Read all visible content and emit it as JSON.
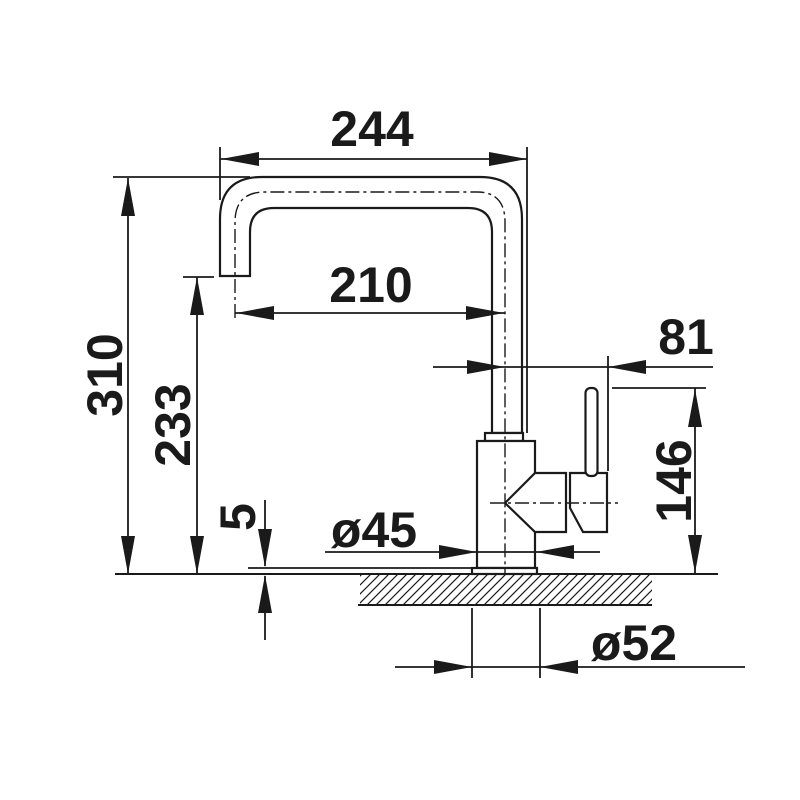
{
  "drawing": {
    "type": "faucet-dimension-diagram",
    "background": "#ffffff",
    "line_color": "#1a1a1a",
    "labels": {
      "spout_width_top": "244",
      "spout_reach": "210",
      "handle_offset": "81",
      "total_height": "310",
      "outlet_height": "233",
      "handle_height": "146",
      "base_plate_thickness": "5",
      "body_diameter": "ø45",
      "base_diameter": "ø52"
    },
    "dimensions_mm": {
      "spout_width_top": 244,
      "spout_reach": 210,
      "handle_offset": 81,
      "total_height": 310,
      "outlet_height": 233,
      "handle_height": 146,
      "base_plate_thickness": 5,
      "body_diameter": 45,
      "base_diameter": 52
    }
  }
}
